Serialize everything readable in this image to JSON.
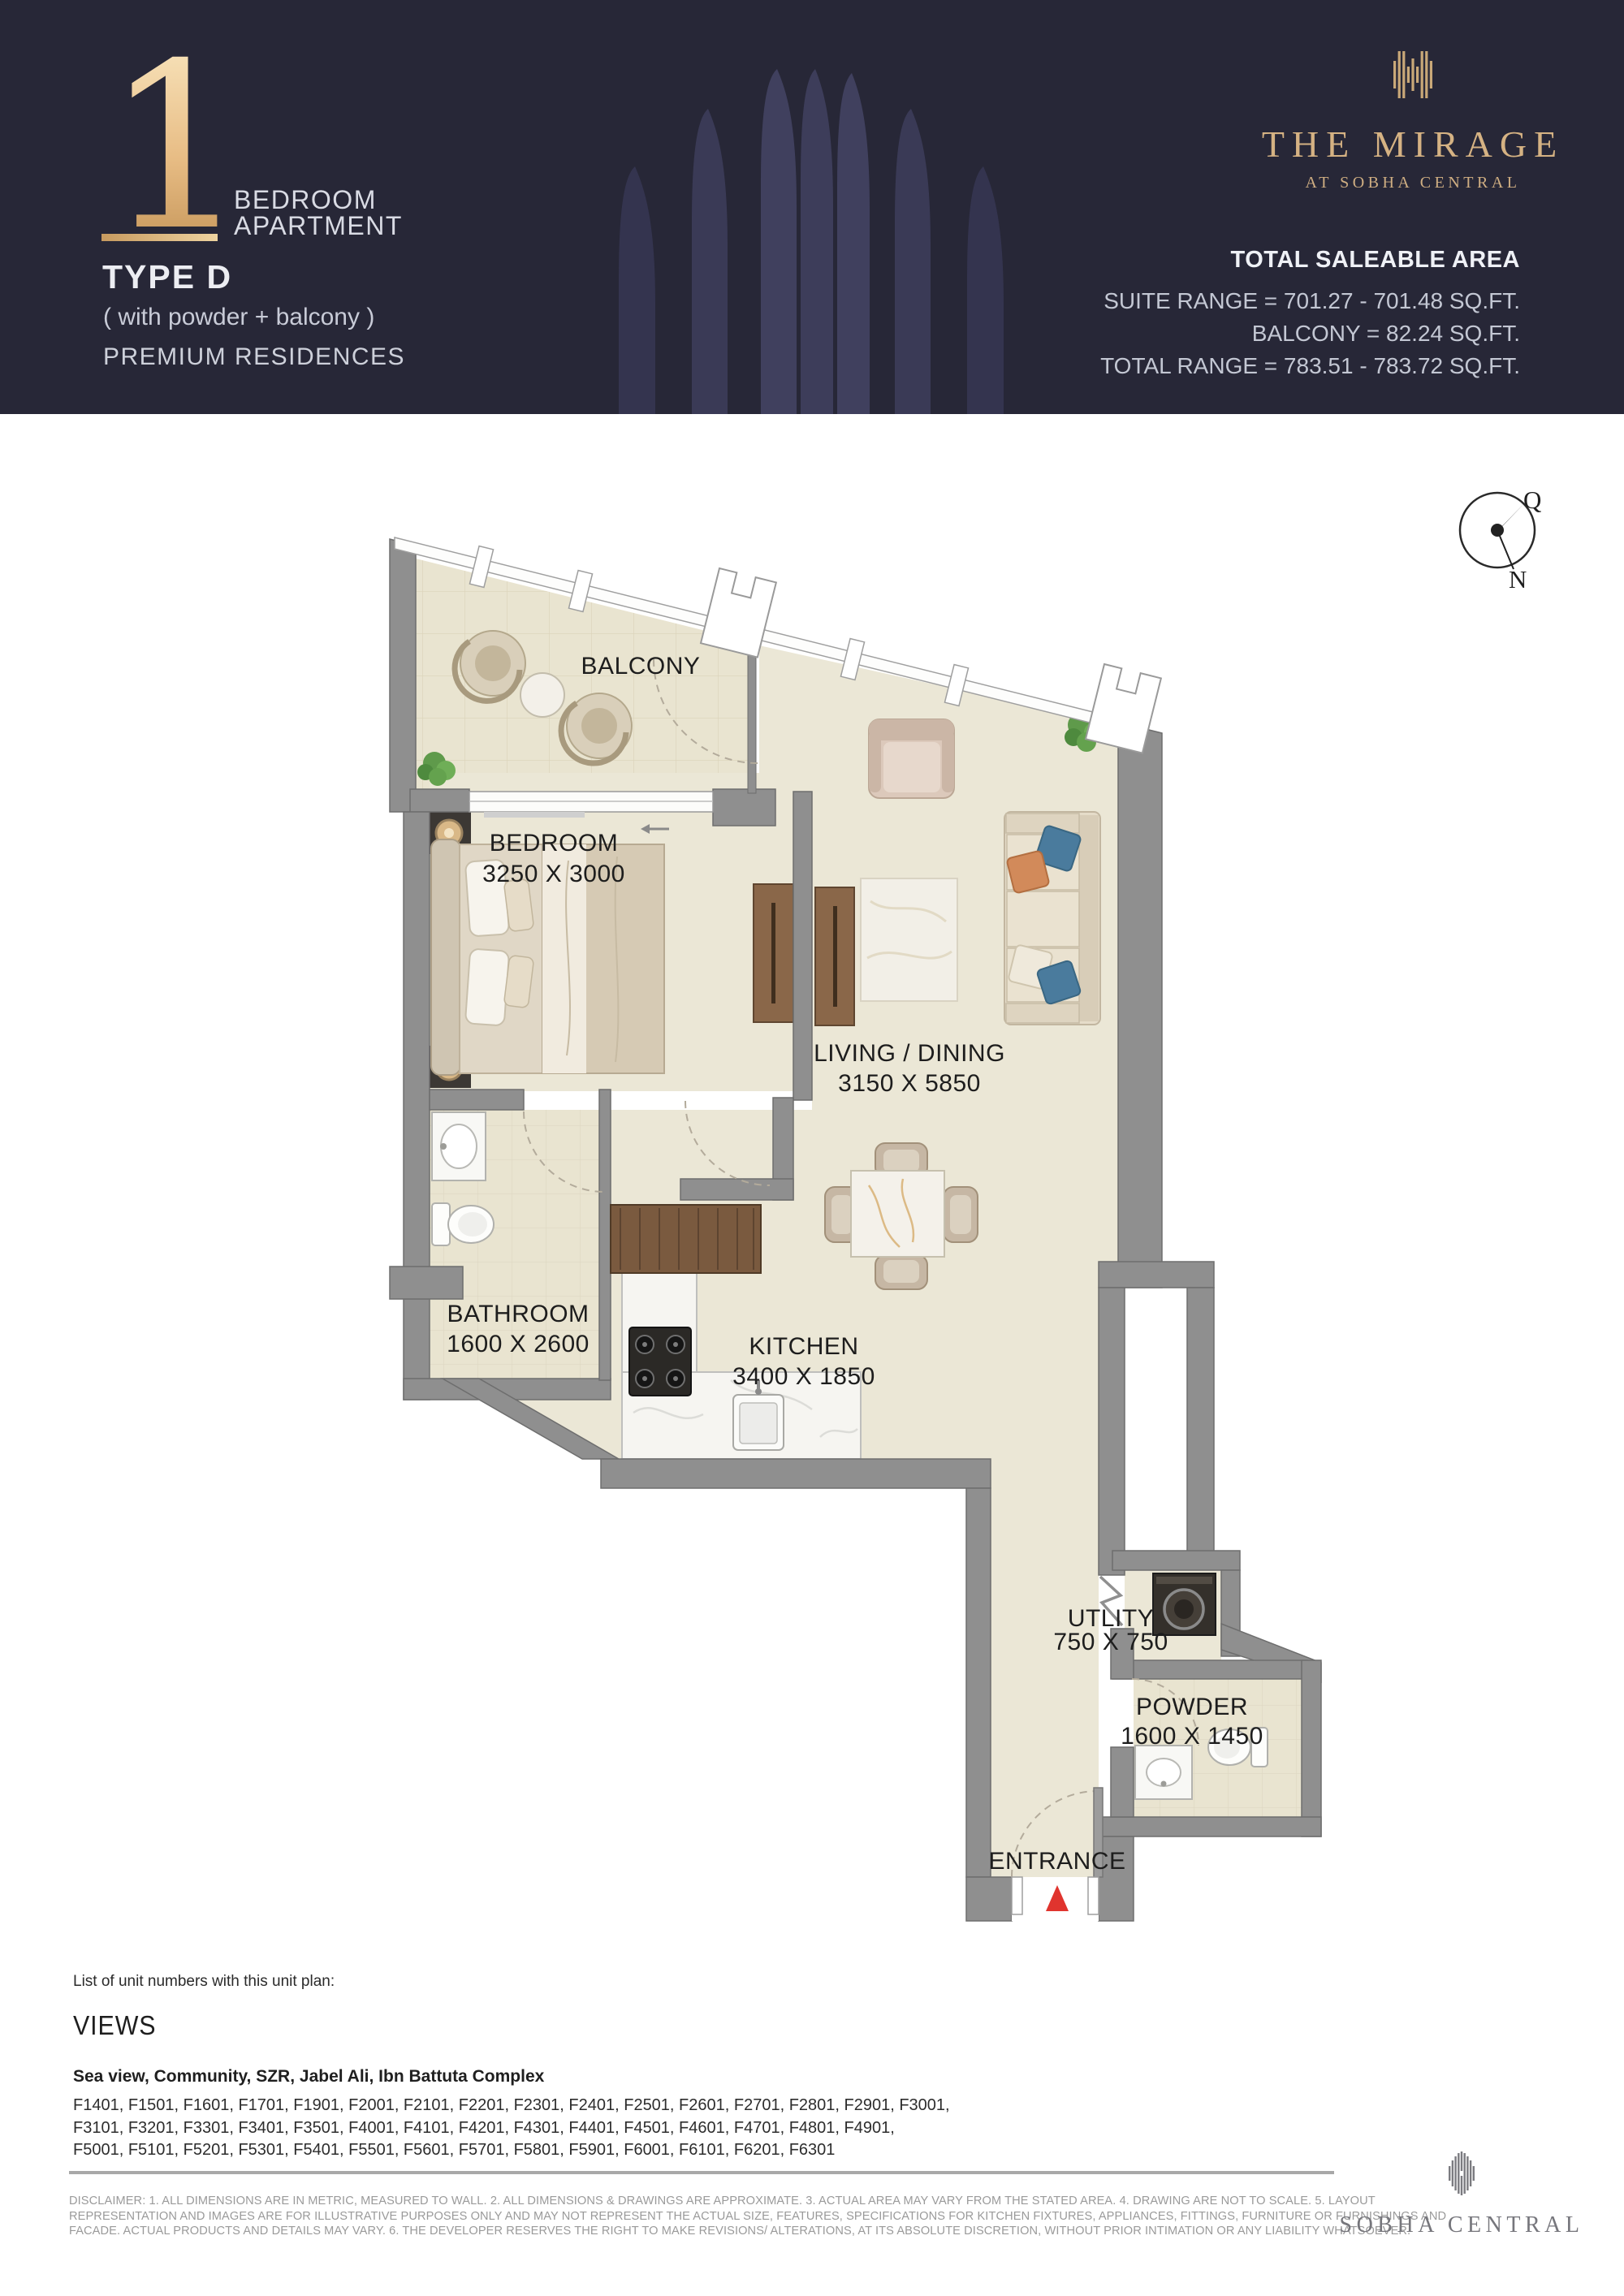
{
  "header": {
    "unit_number": "1",
    "unit_line1": "BEDROOM",
    "unit_line2": "APARTMENT",
    "type_label": "TYPE D",
    "subtitle": "( with powder + balcony )",
    "category": "PREMIUM RESIDENCES",
    "brand": {
      "name": "THE MIRAGE",
      "tagline": "AT SOBHA CENTRAL"
    },
    "area": {
      "title": "TOTAL SALEABLE AREA",
      "suite": "SUITE RANGE = 701.27 - 701.48 SQ.FT.",
      "balcony": "BALCONY = 82.24 SQ.FT.",
      "total": "TOTAL RANGE = 783.51 - 783.72 SQ.FT."
    },
    "colors": {
      "background": "#272737",
      "gold": "#d5b283"
    }
  },
  "compass": {
    "q": "Q",
    "n": "N"
  },
  "plan": {
    "labels": {
      "balcony": "BALCONY",
      "bedroom": "BEDROOM",
      "bedroom_dims": "3250 X 3000",
      "living": "LIVING / DINING",
      "living_dims": "3150 X 5850",
      "bathroom": "BATHROOM",
      "bathroom_dims": "1600 X 2600",
      "kitchen": "KITCHEN",
      "kitchen_dims": "3400 X 1850",
      "utility": "UTLITY",
      "utility_dims": "750 X 750",
      "powder": "POWDER",
      "powder_dims": "1600 X 1450",
      "entrance": "ENTRANCE"
    },
    "colors": {
      "wall": "#8f8f8f",
      "floor": "#ebe7d6",
      "tile": "#e9e4d0",
      "entrance_marker": "#e0342e"
    }
  },
  "footer": {
    "list_label": "List of unit numbers with this unit plan:",
    "views_title": "VIEWS",
    "views_line": "Sea view, Community, SZR, Jabel Ali, Ibn Battuta Complex",
    "units_lines": [
      "F1401, F1501, F1601, F1701, F1901, F2001, F2101, F2201, F2301, F2401, F2501, F2601, F2701, F2801, F2901, F3001,",
      "F3101, F3201, F3301, F3401, F3501, F4001, F4101, F4201, F4301, F4401, F4501, F4601, F4701, F4801, F4901,",
      "F5001, F5101, F5201, F5301, F5401, F5501, F5601, F5701, F5801, F5901, F6001, F6101, F6201, F6301"
    ],
    "disclaimer_lines": [
      "DISCLAIMER: 1. ALL DIMENSIONS ARE IN METRIC, MEASURED TO WALL. 2. ALL DIMENSIONS & DRAWINGS ARE APPROXIMATE.  3. ACTUAL AREA MAY VARY FROM THE STATED AREA. 4. DRAWING ARE NOT TO SCALE. 5. LAYOUT",
      "REPRESENTATION AND IMAGES ARE FOR ILLUSTRATIVE PURPOSES ONLY AND MAY NOT REPRESENT THE ACTUAL SIZE, FEATURES, SPECIFICATIONS FOR KITCHEN FIXTURES, APPLIANCES, FITTINGS, FURNITURE OR FURNISHINGS AND",
      "FACADE. ACTUAL PRODUCTS AND DETAILS MAY VARY. 6. THE DEVELOPER RESERVES THE RIGHT TO MAKE REVISIONS/ ALTERATIONS, AT ITS ABSOLUTE DISCRETION, WITHOUT PRIOR INTIMATION OR ANY LIABILITY WHATSOEVER.",
      "SOBHA CENTRAL"
    ]
  }
}
